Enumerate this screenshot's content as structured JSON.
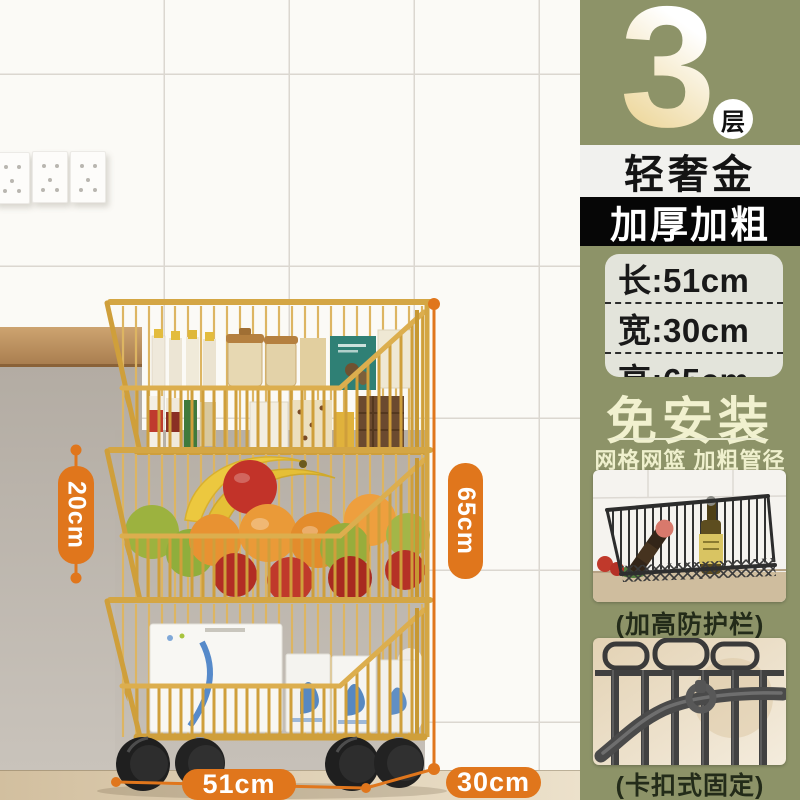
{
  "product_badge": {
    "count": "3",
    "unit": "层"
  },
  "color_band": {
    "label": "轻奢金"
  },
  "feature_band": {
    "label": "加厚加粗"
  },
  "size_box": {
    "rows": [
      {
        "text": "长:51cm"
      },
      {
        "text": "宽:30cm"
      },
      {
        "text": "高:65cm"
      }
    ]
  },
  "selling_points": {
    "headline": "免安装",
    "subline": "网格网篮 加粗管径"
  },
  "detail_photos": [
    {
      "caption": "(加高防护栏)"
    },
    {
      "caption": "(卡扣式固定)"
    }
  ],
  "dimension_labels": {
    "tier_height": "20cm",
    "total_height": "65cm",
    "length": "51cm",
    "depth": "30cm"
  },
  "colors": {
    "accent_orange": "#e0761c",
    "panel_olive": "#8d9368",
    "cart_gold": "#d2a343",
    "band_black": "#060606",
    "band_light": "#f1f1ee",
    "cream_text": "#f0f0cd"
  }
}
